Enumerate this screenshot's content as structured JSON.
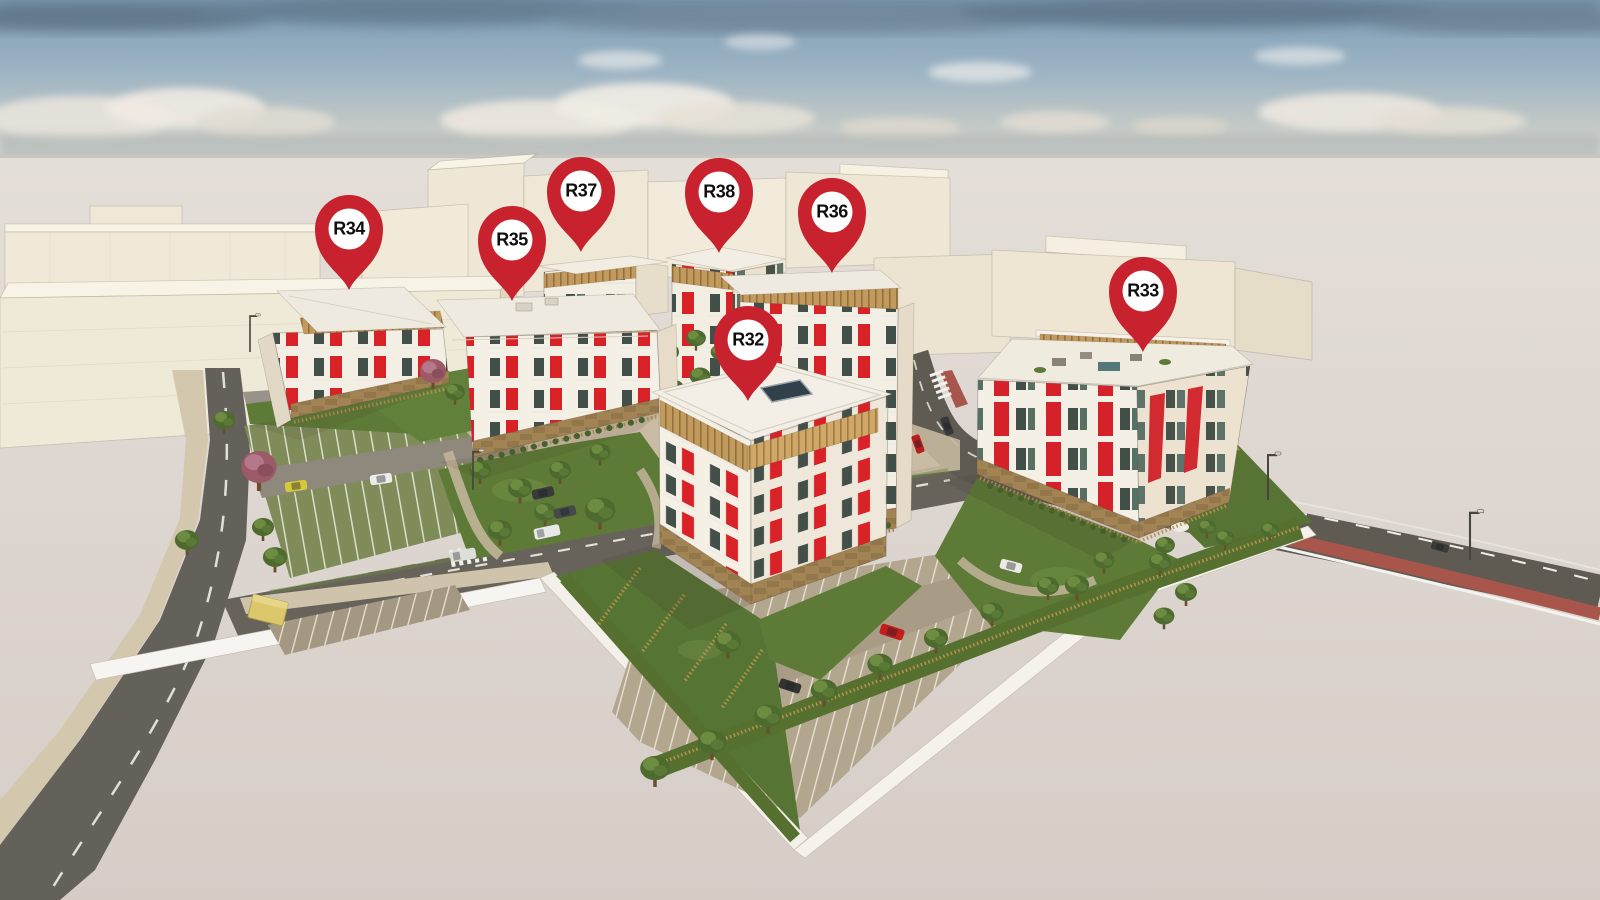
{
  "pins": {
    "items": [
      {
        "id": "r32",
        "label": "R32"
      },
      {
        "id": "r33",
        "label": "R33"
      },
      {
        "id": "r34",
        "label": "R34"
      },
      {
        "id": "r35",
        "label": "R35"
      },
      {
        "id": "r36",
        "label": "R36"
      },
      {
        "id": "r37",
        "label": "R37"
      },
      {
        "id": "r38",
        "label": "R38"
      }
    ]
  },
  "palette": {
    "pin_red": "#c7222d",
    "facade_accent_red": "#d92227",
    "facade_cream": "#f4efe5",
    "wood": "#c39a5e",
    "sky_blue": "#8aa7bd",
    "ground": "#ddd6d0",
    "road_gray": "#64605a",
    "bike_lane_red": "#a8564c",
    "grass_green": "#5d7a36"
  }
}
